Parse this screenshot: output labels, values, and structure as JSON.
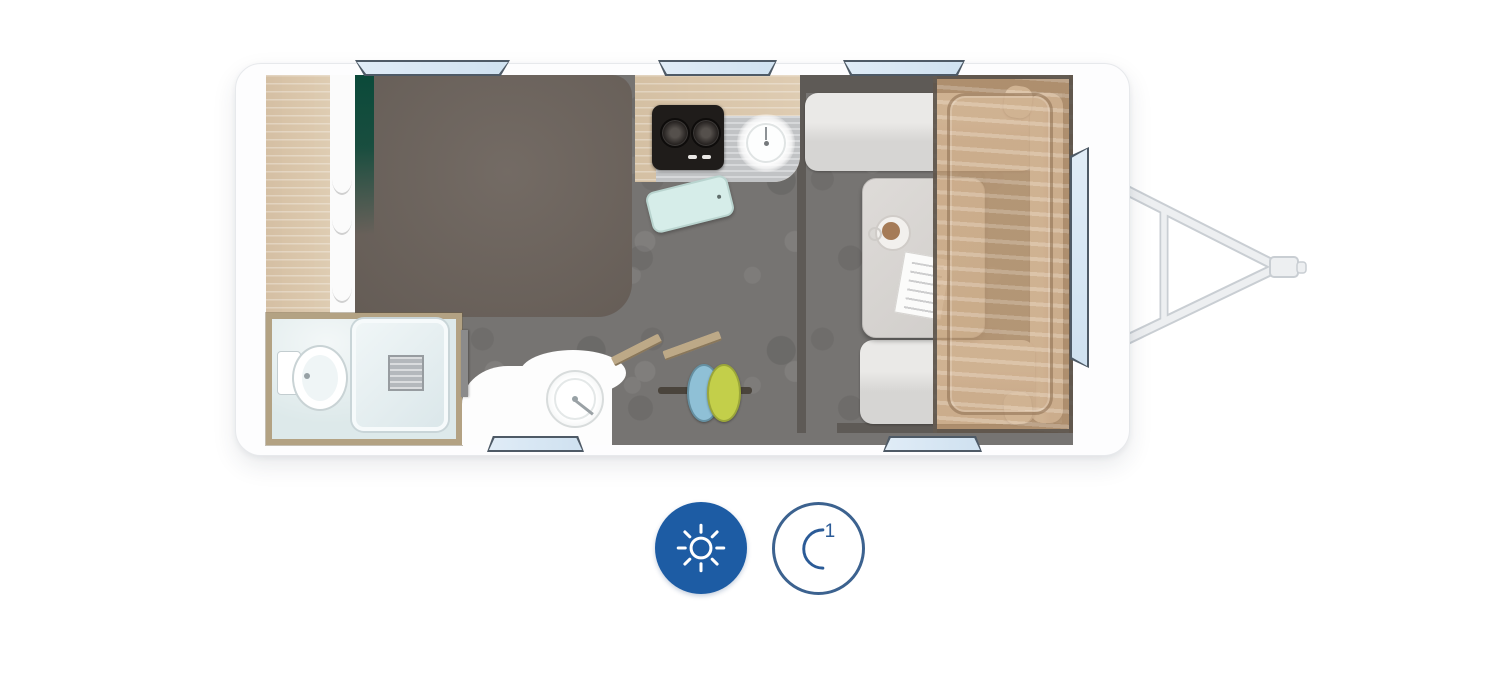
{
  "app": {
    "type": "caravan-floorplan-viewer",
    "background": "#ffffff"
  },
  "palette": {
    "body": "#fdfdfe",
    "floor": "#767472",
    "bed": "#6c635c",
    "green": "#0b4a3a",
    "wood_light": "#dcc8ac",
    "wood_cabinet": "#d2bb9b",
    "wood_frame": "#bda987",
    "overlay_wood": "rgba(205,167,125,0.75)",
    "sofa_frame": "#5e5a56",
    "cushion": "#d6d5d3",
    "cushion_light": "#eae9e7",
    "table": "#d9d6d3",
    "bathroom_floor": "#dde9ea",
    "bathroom_frame": "#b3a283",
    "window_fill": "#cfe1f0",
    "window_frame": "#4e5a66",
    "stove": "#1f1c1a",
    "coffee": "#a57b57",
    "stool_blue": "#8fc0d6",
    "stool_green": "#c3cf4a",
    "board": "#d6ede9",
    "hitch": "#edeff1",
    "hitch_shadow": "#c9ced3",
    "counter_gray": "#c9cbcd",
    "day_bg": "#1d5ca4",
    "day_fg": "#ffffff",
    "night_fg": "#2b5b97",
    "night_border": "#3c628f"
  },
  "controls": {
    "day": {
      "icon": "sun-icon",
      "active": true
    },
    "night": {
      "icon": "moon-icon",
      "badge": "1",
      "active": false
    }
  }
}
